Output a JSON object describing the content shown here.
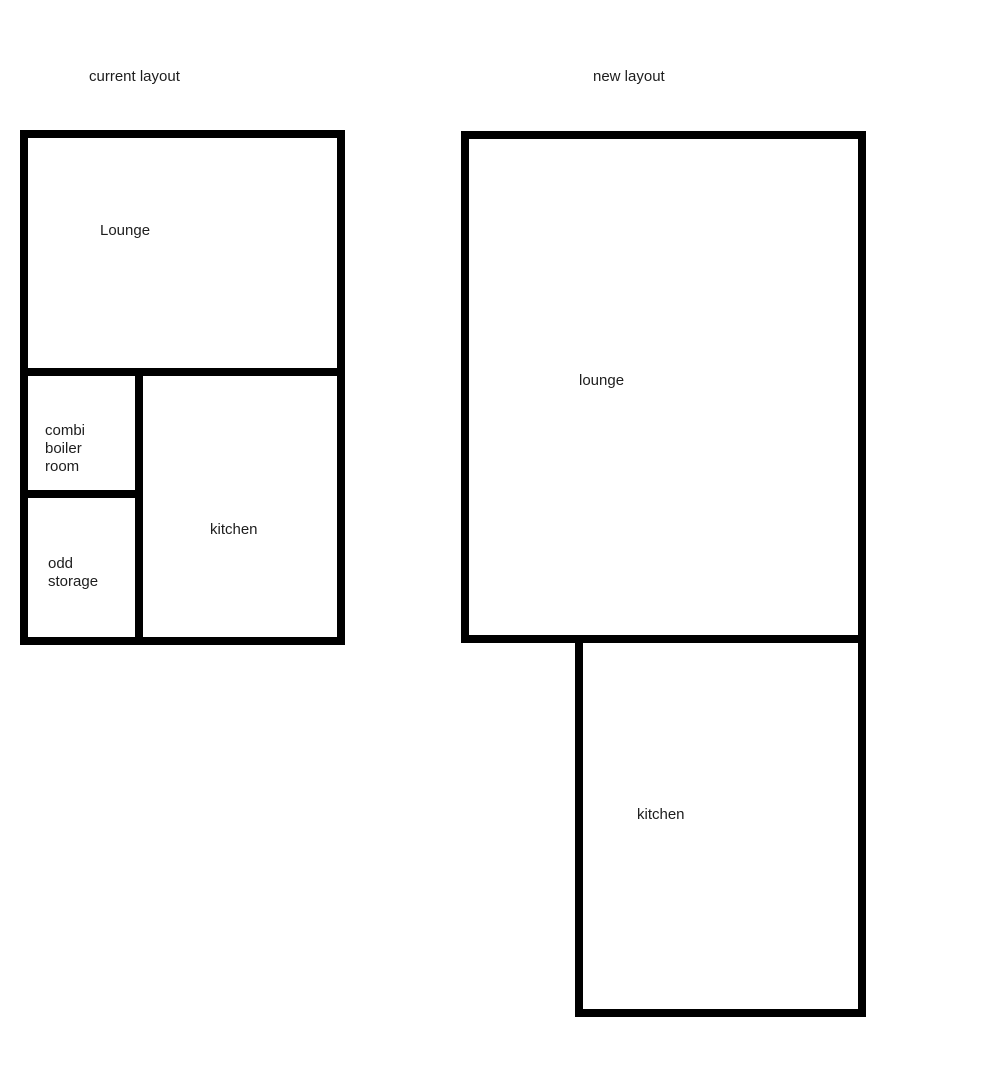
{
  "page": {
    "background_color": "#ffffff",
    "wall_color": "#000000",
    "text_color": "#1d1d1d"
  },
  "current_plan": {
    "title": "current layout",
    "rooms": {
      "lounge": {
        "label": "Lounge"
      },
      "combi_boiler": {
        "label": "combi\nboiler\nroom"
      },
      "odd_storage": {
        "label": "odd\nstorage"
      },
      "kitchen": {
        "label": "kitchen"
      }
    }
  },
  "new_plan": {
    "title": "new layout",
    "rooms": {
      "lounge": {
        "label": "lounge"
      },
      "kitchen": {
        "label": "kitchen"
      }
    }
  }
}
